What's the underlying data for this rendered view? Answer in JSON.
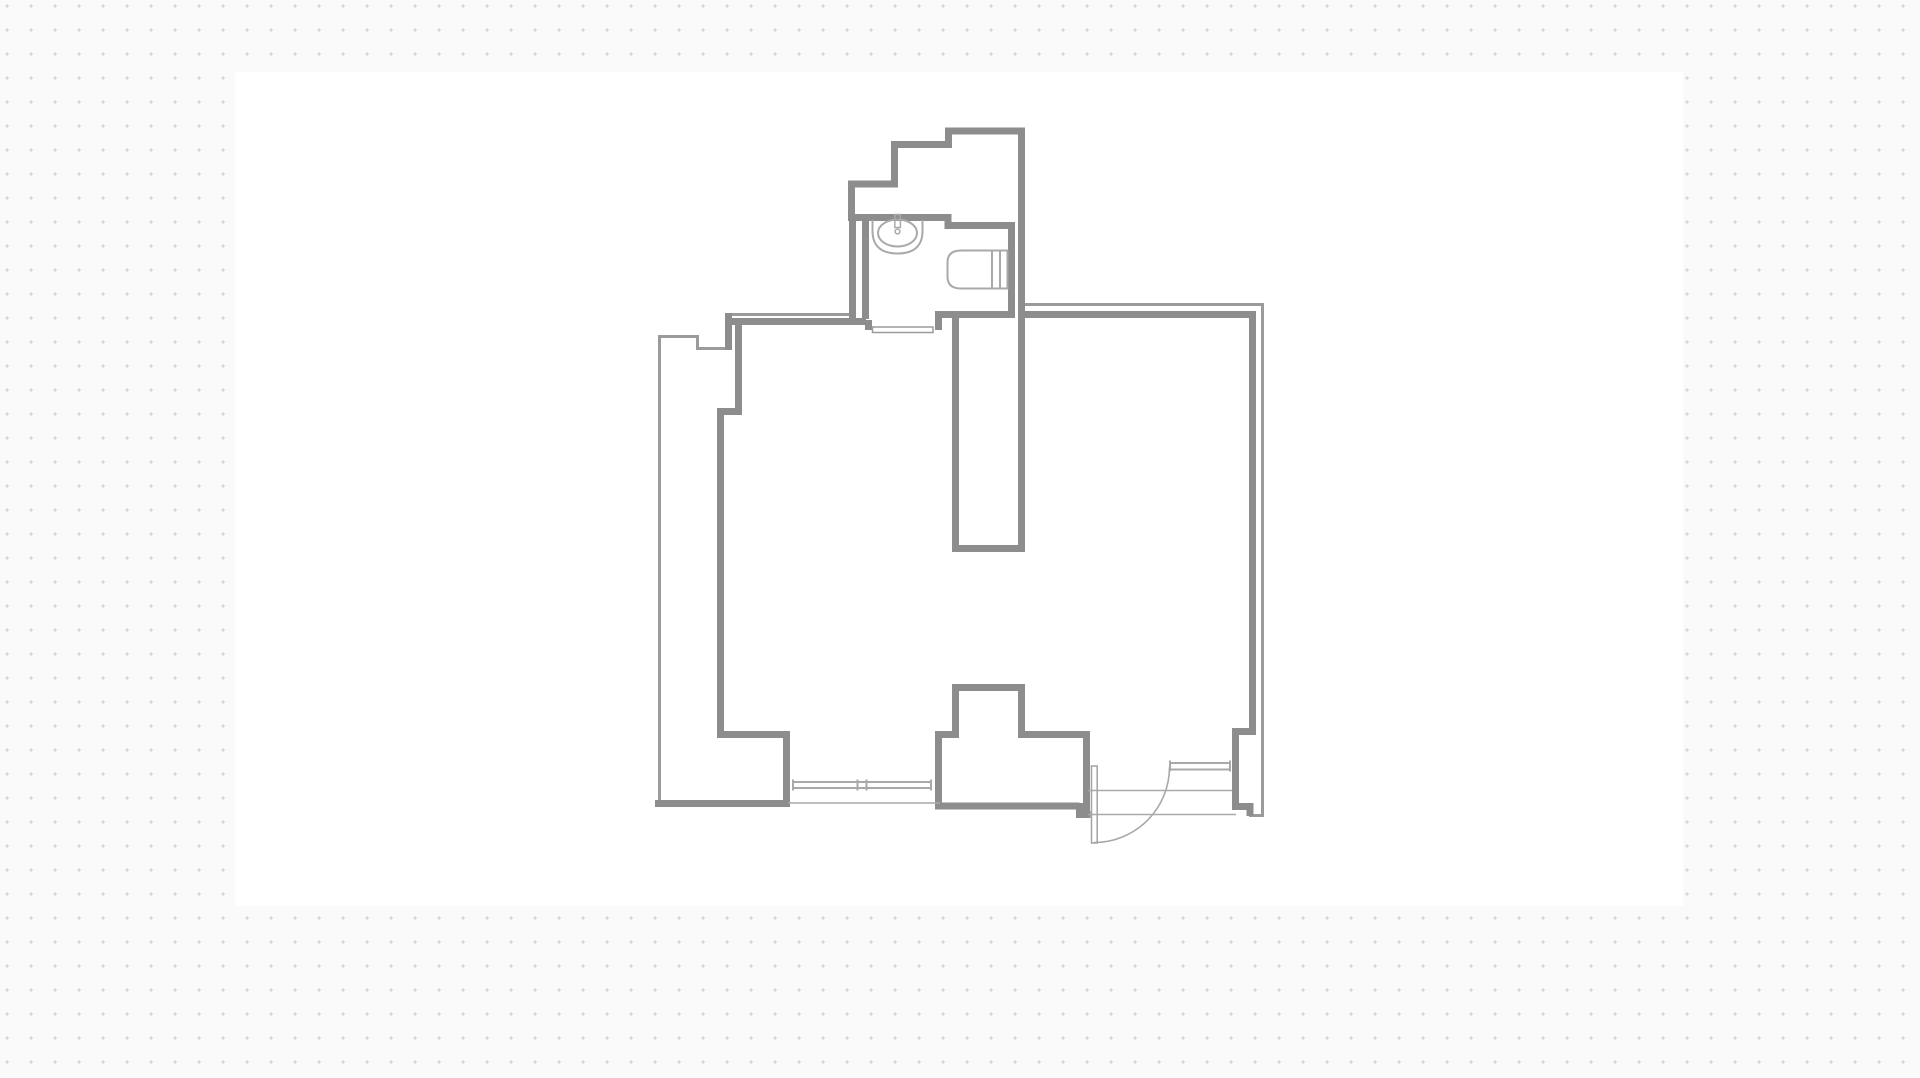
{
  "canvas": {
    "background_color": "#fafafa",
    "dot_color": "#d5d5d5",
    "dot_spacing_px": 24,
    "sheet": {
      "x": 235,
      "y": 72,
      "width": 1448,
      "height": 834,
      "color": "#ffffff"
    }
  },
  "floor_plan": {
    "viewbox": "0 0 1920 1078",
    "colors": {
      "wall_thick": "#8d8d8d",
      "wall_thin": "#9b9b9b",
      "opening": "#a9a9a9",
      "fixture": "#a9a9a9",
      "fill_white": "#ffffff"
    },
    "layers": [
      {
        "name": "outer-boundaries",
        "stroke": "#9b9b9b",
        "width": 3,
        "paths": [
          {
            "name": "outer-boundary-left-notch",
            "d": "M 727 348.5 L 697.5 348.5 L 697.5 336.5 L 659.5 336.5 L 659.5 805"
          },
          {
            "name": "outer-boundary-top-living",
            "d": "M 727 314.5 L 852 314.5"
          },
          {
            "name": "outer-boundary-bedroom",
            "d": "M 1020 304.5 L 1262.5 304.5 L 1262.5 815.5 L 1249 815.5"
          }
        ]
      },
      {
        "name": "walls-thick",
        "stroke": "#8d8d8d",
        "width": 7,
        "paths": [
          {
            "name": "wall-top-stepped",
            "d": "M 851.5 221 L 851.5 184 L 894.5 184 L 894.5 144.5 L 948.5 144.5 L 948.5 131 L 1021.5 131 L 1021.5 548"
          },
          {
            "name": "wall-shaft-cap",
            "d": "M 1025 548.5 L 952 548.5"
          },
          {
            "name": "wall-shaft-left",
            "d": "M 955.5 552 L 955.5 313"
          },
          {
            "name": "wall-bathroom-top-right",
            "d": "M 849 217.5 L 948 217.5 L 948 225.5 L 1011.5 225.5 L 1011.5 313"
          },
          {
            "name": "wall-bathroom-bottom",
            "d": "M 935 314.5 L 1015 314.5"
          },
          {
            "name": "wall-bathroom-left-outer-face",
            "d": "M 852.5 216 L 852.5 319"
          },
          {
            "name": "wall-bathroom-left-inner-face",
            "d": "M 865.5 216 L 865.5 319"
          },
          {
            "name": "wall-living-top",
            "d": "M 727 321.5 L 866 321.5"
          },
          {
            "name": "wall-bath-door-jamb-left",
            "d": "M 868.5 320 L 868.5 330"
          },
          {
            "name": "wall-bath-door-jamb-right",
            "d": "M 938.5 316 L 938.5 330"
          },
          {
            "name": "wall-top-left-corner-post",
            "d": "M 728.5 313 L 728.5 350"
          },
          {
            "name": "wall-living-interior-left",
            "d": "M 738.5 318 L 738.5 411.5 L 720.5 411.5 L 720.5 734.5 L 786.5 734.5 L 786.5 805"
          },
          {
            "name": "wall-bottom-left",
            "d": "M 655 803.5 L 790 803.5"
          },
          {
            "name": "wall-entry-left",
            "d": "M 938.5 809 L 938.5 731"
          },
          {
            "name": "wall-entry-shelf",
            "d": "M 935 734.5 L 959 734.5"
          },
          {
            "name": "wall-entry-closet-block",
            "d": "M 955.5 737 L 955.5 687.5 L 1021.5 687.5 L 1021.5 737"
          },
          {
            "name": "wall-entry-top",
            "d": "M 1018 734.5 L 1090 734.5"
          },
          {
            "name": "wall-entry-right",
            "d": "M 1086.5 732 L 1086.5 812"
          },
          {
            "name": "wall-entry-bottom",
            "d": "M 935 806 L 1079.5 806"
          },
          {
            "name": "wall-entry-bottom-step",
            "d": "M 1079.5 803 L 1079.5 814.5 L 1090.5 814.5"
          },
          {
            "name": "wall-bedroom-top",
            "d": "M 1021.5 314.5 L 1252.5 314.5"
          },
          {
            "name": "wall-bedroom-right",
            "d": "M 1252.5 311 L 1252.5 731.5 L 1235.5 731.5 L 1235.5 806.5 L 1250 806.5 L 1250 816"
          }
        ]
      },
      {
        "name": "fixtures",
        "stroke": "#a9a9a9",
        "width": 2,
        "paths": [
          {
            "name": "sink-outer",
            "d": "M 872.5 220 L 872.5 231 C 872.5 247.5 883 253.5 897.5 253.5 C 912 253.5 922.5 247.5 922.5 231 L 922.5 220",
            "fill": "#ffffff"
          },
          {
            "name": "sink-basin",
            "d": "M 878 233 a 19.5 13.5 0 1 0 39 0 a 19.5 13.5 0 1 0 -39 0",
            "fill": "#ffffff"
          },
          {
            "name": "sink-faucet",
            "d": "M 894.8 214.5 L 900.4 214.5 L 900.4 227.5 L 894.8 227.5 Z M 895.1 231.5 a 2.4 2.4 0 1 0 4.8 0 a 2.4 2.4 0 1 0 -4.8 0",
            "width": 1.5,
            "fill": "#ffffff"
          },
          {
            "name": "bathtub",
            "d": "M 1007.5 250.5 L 961 250.5 Q 947.5 250.5 947.5 262.5 L 947.5 276.5 Q 947.5 288.5 961 288.5 L 1007.5 288.5 Z",
            "fill": "#ffffff"
          },
          {
            "name": "bathtub-rim-lines",
            "d": "M 992 250.5 L 992 288.5 M 1000 250.5 L 1000 288.5"
          }
        ]
      },
      {
        "name": "openings",
        "stroke": "#a9a9a9",
        "width": 2,
        "paths": [
          {
            "name": "window-living",
            "d": "M 792 782 L 932 782 M 792 788 L 932 788 M 793 779.5 L 793 790.5 M 931 779.5 L 931 790.5 M 857.5 779.5 L 857.5 790.5 M 866.5 779.5 L 866.5 790.5"
          },
          {
            "name": "window-bedroom",
            "d": "M 1169 763 L 1231 763 M 1169 769.5 L 1231 769.5 M 1170 760.5 L 1170 771.5 M 1230 760.5 L 1230 771.5"
          },
          {
            "name": "sill-line-left",
            "d": "M 788 803 L 940 803",
            "width": 1.6
          },
          {
            "name": "door-opening-lines",
            "d": "M 1088 790.5 L 1232 790.5 M 1088 814.5 L 1236 814.5",
            "width": 1.6
          },
          {
            "name": "door-swing-arc",
            "d": "M 1094 842.5 A 75.5 75.5 0 0 0 1169.5 767",
            "width": 1.6
          }
        ]
      },
      {
        "name": "overlays",
        "stroke": "#9b9b9b",
        "width": 1.5,
        "paths": [
          {
            "name": "bath-door-threshold",
            "d": "M 872.5 327 L 933 327 L 933 332.5 L 872.5 332.5 Z",
            "fill": "#ffffff"
          },
          {
            "name": "door-leaf",
            "d": "M 1091.5 766 L 1097.2 766 L 1097.2 843 L 1091.5 843 Z",
            "fill": "#ffffff",
            "stroke": "#a3a3a3"
          }
        ]
      }
    ]
  }
}
